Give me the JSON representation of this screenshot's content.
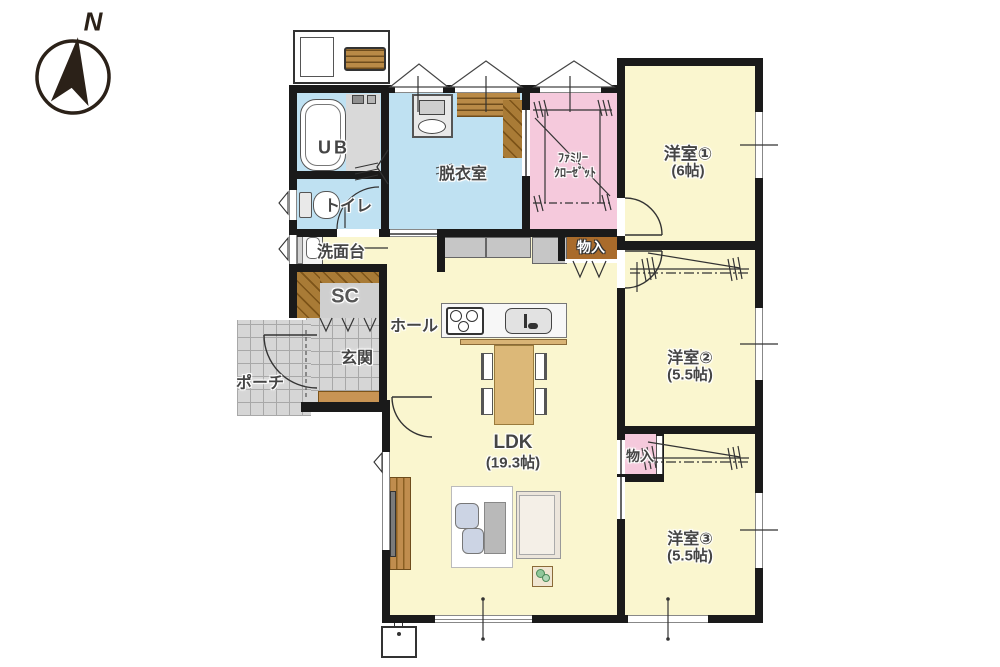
{
  "compass": {
    "label": "N"
  },
  "palette": {
    "wall": "#1a1a1a",
    "living_yellow": "#faf6cf",
    "wet_blue": "#bfe1f2",
    "closet_pink": "#f5c9dc",
    "tile_gray": "#d6d6d6",
    "wood_brown": "#a97b36",
    "table_tan": "#dcb878"
  },
  "rooms": {
    "unit_bath": {
      "label": "UB"
    },
    "dressing_room": {
      "label": "脱衣室"
    },
    "family_closet": {
      "line1": "ﾌｧﾐﾘｰ",
      "line2": "ｸﾛｰｾﾞｯﾄ"
    },
    "bedroom1": {
      "label": "洋室①",
      "size": "(6帖)"
    },
    "toilet": {
      "label": "トイレ"
    },
    "washstand": {
      "label": "洗面台"
    },
    "shoe_closet": {
      "label": "SC"
    },
    "hall": {
      "label": "ホール"
    },
    "entrance": {
      "label": "玄関"
    },
    "porch": {
      "label": "ポーチ"
    },
    "storage_hall": {
      "label": "物入"
    },
    "bedroom2": {
      "label": "洋室②",
      "size": "(5.5帖)"
    },
    "ldk": {
      "label": "LDK",
      "size": "(19.3帖)"
    },
    "storage_bedroom3": {
      "label": "物入"
    },
    "bedroom3": {
      "label": "洋室③",
      "size": "(5.5帖)"
    }
  }
}
